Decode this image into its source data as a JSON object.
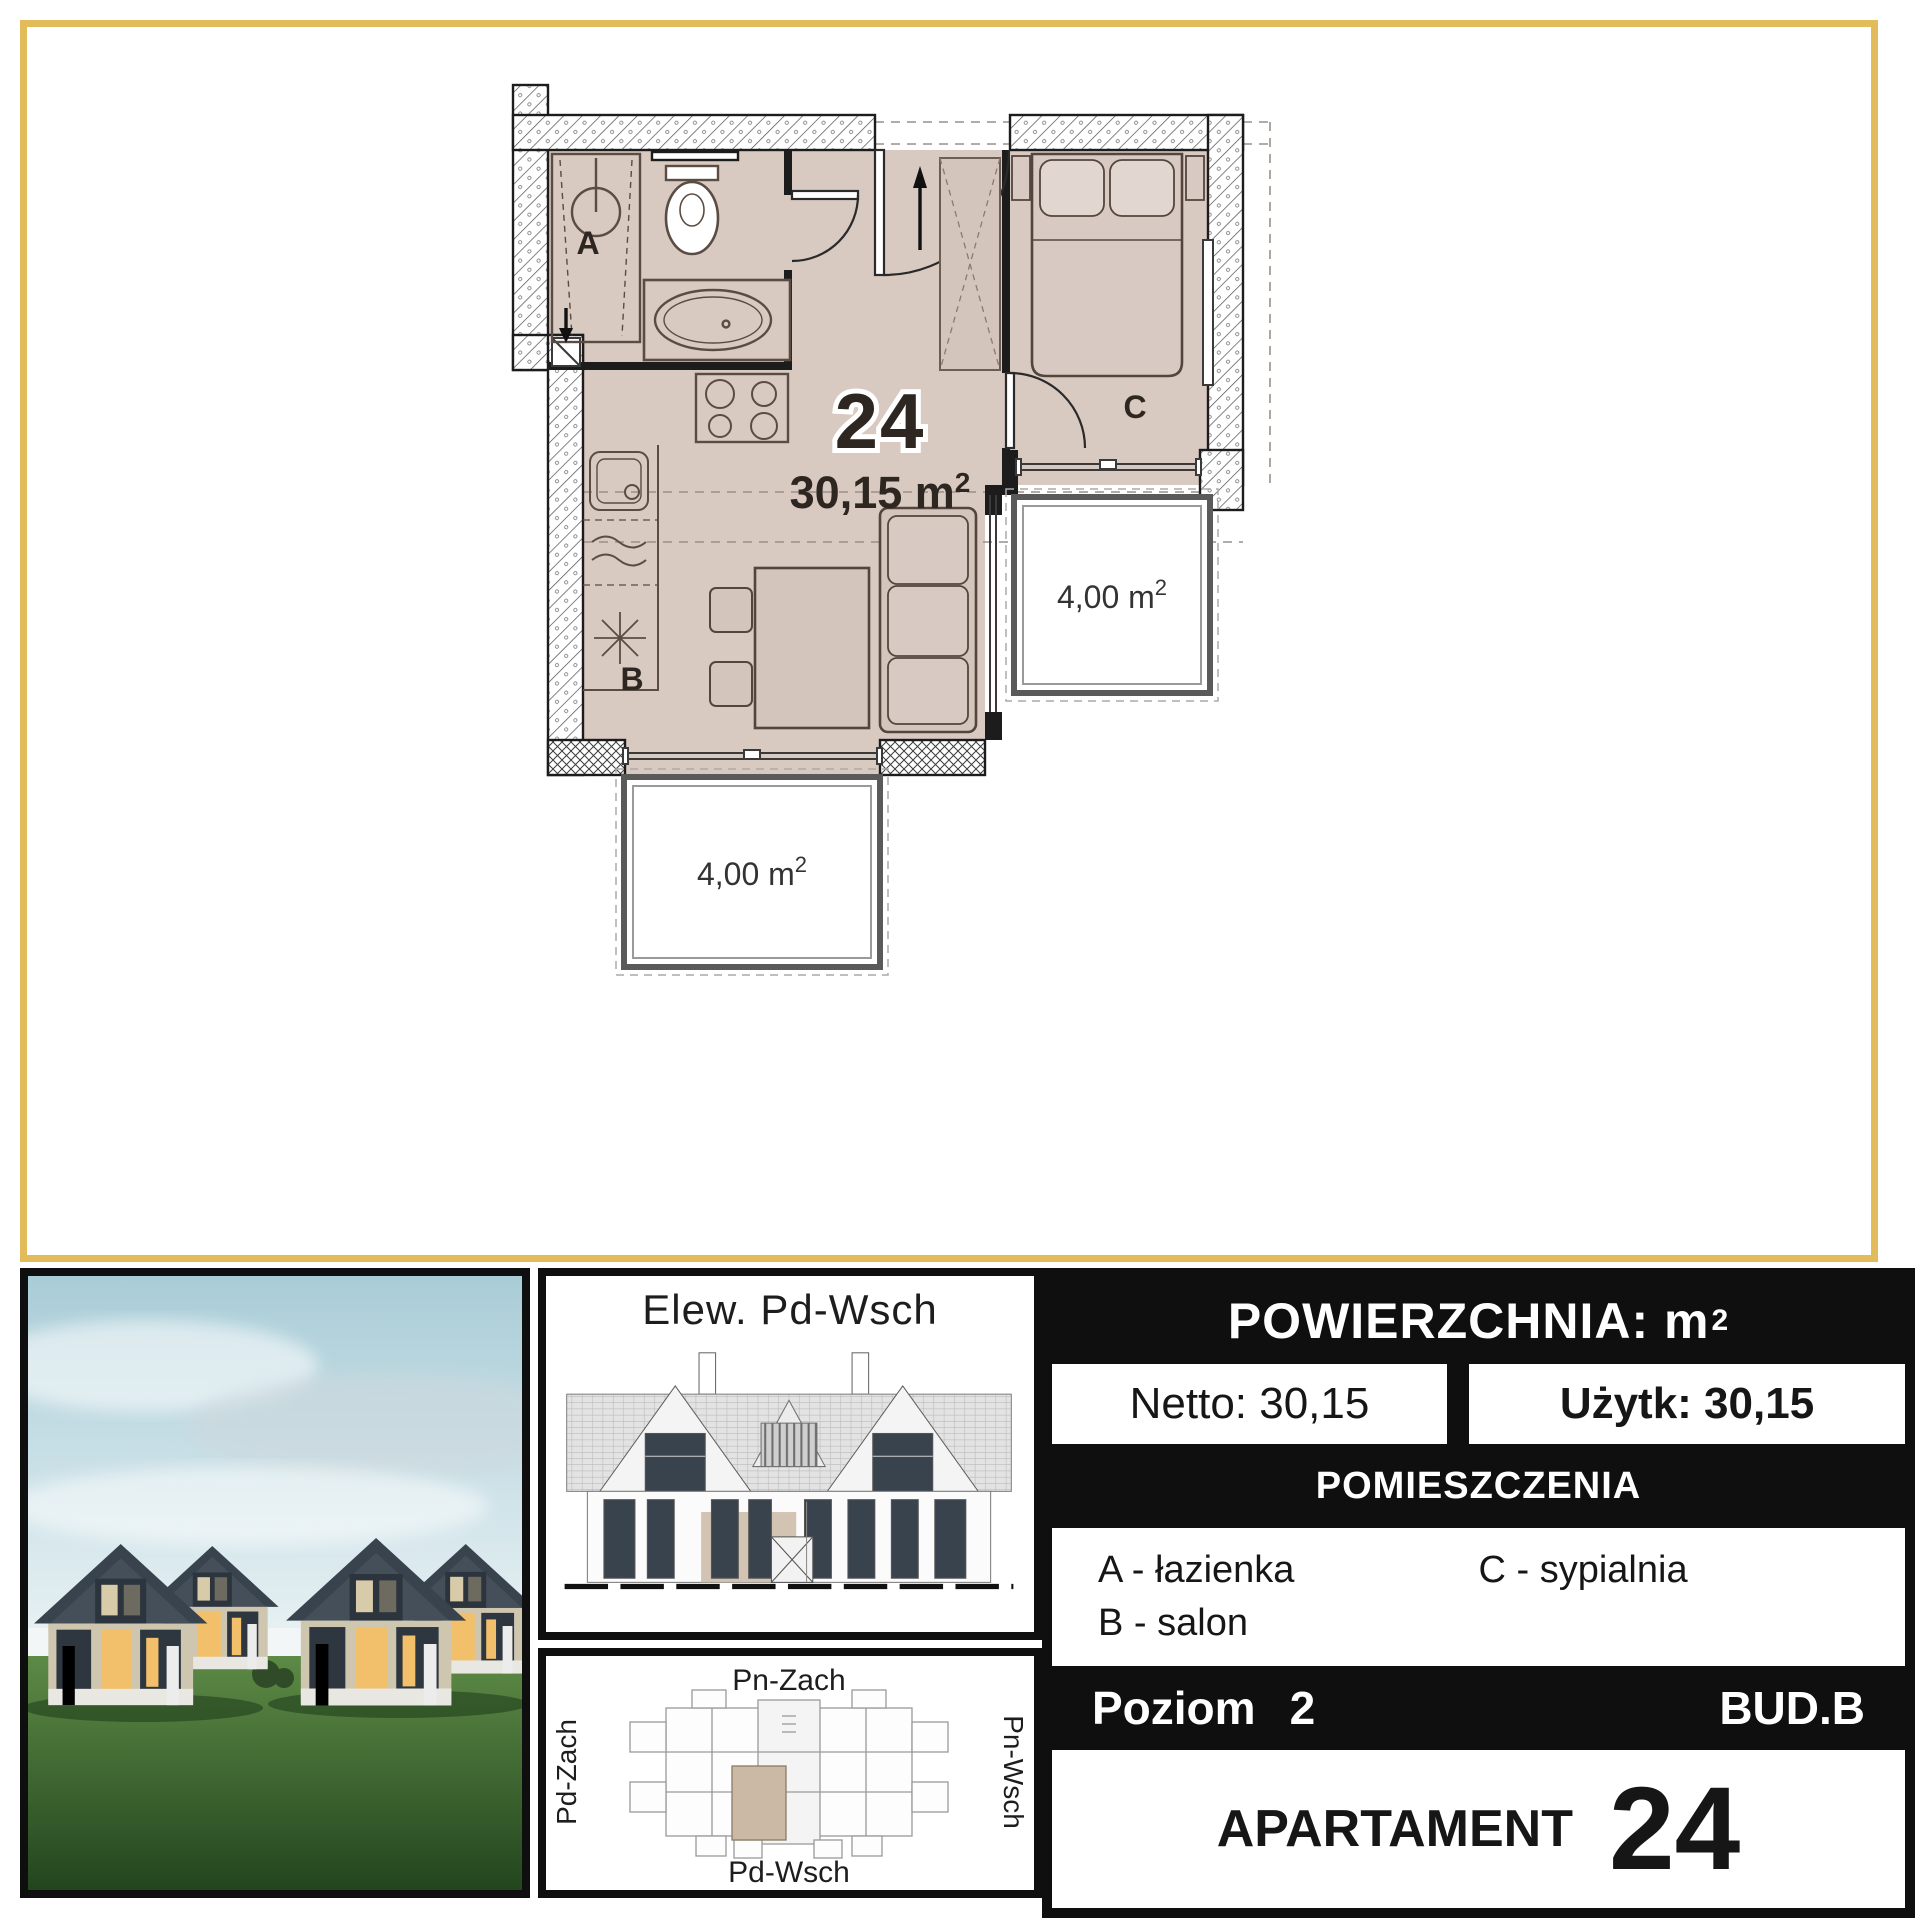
{
  "colors": {
    "frame_gold": "#e2bc5a",
    "panel_black": "#0f0f0f",
    "floor_tan": "#d8c9c1",
    "window_glow": "#f2c06a",
    "roof_dark": "#39434d",
    "grass_green": "#3f6b33",
    "sky_blue": "#aacdd8"
  },
  "floor_plan": {
    "apartment_number": "24",
    "area_value": "30,15 m",
    "area_sup": "2",
    "room_a": "A",
    "room_b": "B",
    "room_c": "C",
    "balcony_bottom_value": "4,00 m",
    "balcony_bottom_sup": "2",
    "balcony_right_value": "4,00 m",
    "balcony_right_sup": "2"
  },
  "elevation_panel": {
    "title": "Elew. Pd-Wsch"
  },
  "site_panel": {
    "label_top": "Pn-Zach",
    "label_bottom": "Pd-Wsch",
    "label_left": "Pd-Zach",
    "label_right": "Pn-Wsch"
  },
  "info_panel": {
    "header_prefix": "POWIERZCHNIA: m",
    "header_sup": "2",
    "netto_label": "Netto: 30,15",
    "uzytk_label": "Użytk: 30,15",
    "rooms_header": "POMIESZCZENIA",
    "legend_a": "A - łazienka",
    "legend_b": "B - salon",
    "legend_c": "C - sypialnia",
    "level_label": "Poziom",
    "level_value": "2",
    "building_label": "BUD.B",
    "apartment_label": "APARTAMENT",
    "apartment_number": "24"
  }
}
